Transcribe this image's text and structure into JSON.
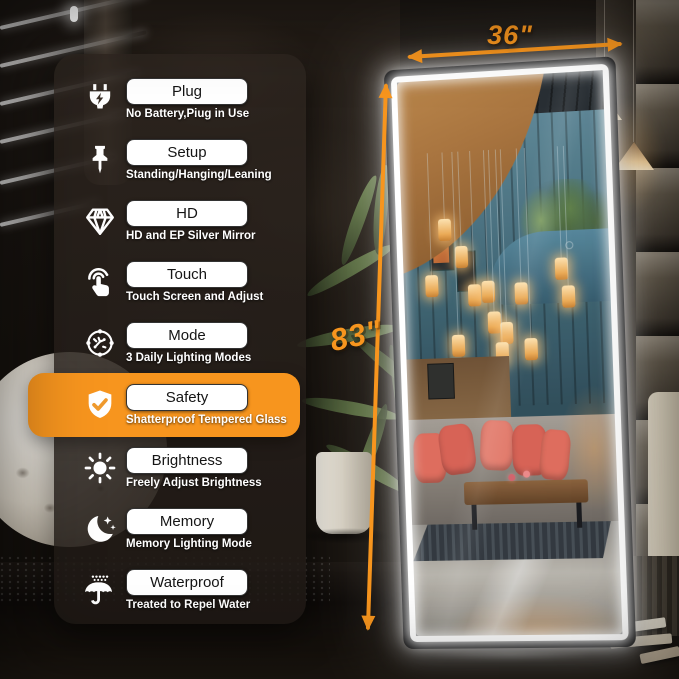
{
  "colors": {
    "accent": "#F7951E",
    "highlight_block": "#F7941E",
    "led": "#FFFFFF"
  },
  "dimensions": {
    "width_label": "36\"",
    "height_label": "83\""
  },
  "features_panel": {
    "items": [
      {
        "icon": "plug-icon",
        "label": "Plug",
        "subtitle": "No Battery,Piug in Use",
        "highlight": false
      },
      {
        "icon": "pin-icon",
        "label": "Setup",
        "subtitle": "Standing/Hanging/Leaning",
        "highlight": false
      },
      {
        "icon": "diamond-icon",
        "label": "HD",
        "subtitle": "HD and EP Silver Mirror",
        "highlight": false
      },
      {
        "icon": "touch-icon",
        "label": "Touch",
        "subtitle": "Touch Screen and Adjust",
        "highlight": false
      },
      {
        "icon": "mode-icon",
        "label": "Mode",
        "subtitle": "3 Daily Lighting Modes",
        "highlight": false
      },
      {
        "icon": "shield-check-icon",
        "label": "Safety",
        "subtitle": "Shatterproof Tempered Glass",
        "highlight": true
      },
      {
        "icon": "sun-icon",
        "label": "Brightness",
        "subtitle": "Freely Adjust Brightness",
        "highlight": false
      },
      {
        "icon": "moon-stars-icon",
        "label": "Memory",
        "subtitle": "Memory Lighting Mode",
        "highlight": false
      },
      {
        "icon": "umbrella-icon",
        "label": "Waterproof",
        "subtitle": "Treated to Repel Water",
        "highlight": false
      }
    ]
  }
}
